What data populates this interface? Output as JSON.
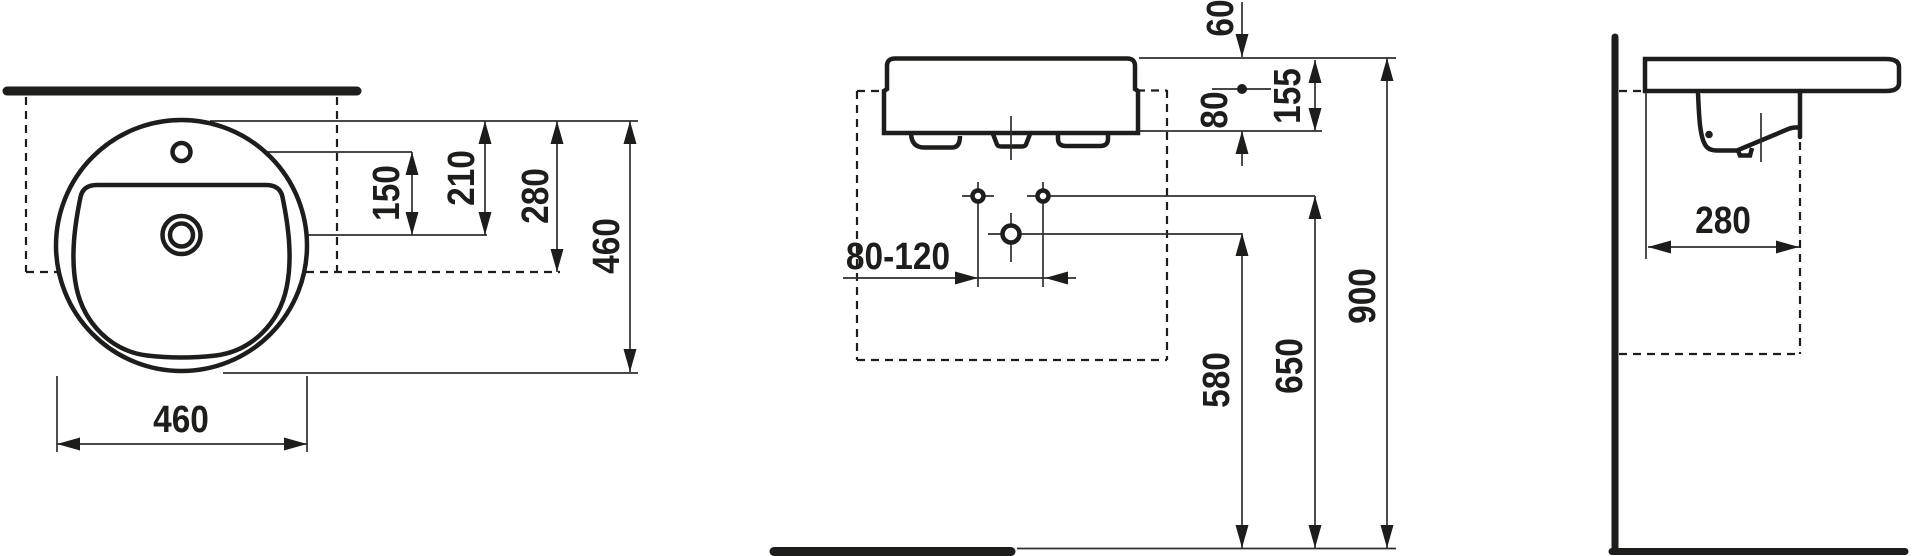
{
  "document": {
    "type": "technical dimension drawing",
    "subject": "round semi-recessed washbasin with tap hole and overflow",
    "units": "mm",
    "colors": {
      "line": "#1d1d1b",
      "background": "#ffffff"
    }
  },
  "views": {
    "top": {
      "name": "top view",
      "dims": {
        "d150": "150",
        "d210": "210",
        "d280": "280",
        "d460_right": "460",
        "d460_bottom": "460"
      }
    },
    "front": {
      "name": "front view",
      "dims": {
        "d60": "60",
        "d80": "80",
        "d155": "155",
        "d80_120": "80-120",
        "d580": "580",
        "d650": "650",
        "d900": "900"
      }
    },
    "side": {
      "name": "side view",
      "dims": {
        "d280": "280"
      }
    }
  }
}
